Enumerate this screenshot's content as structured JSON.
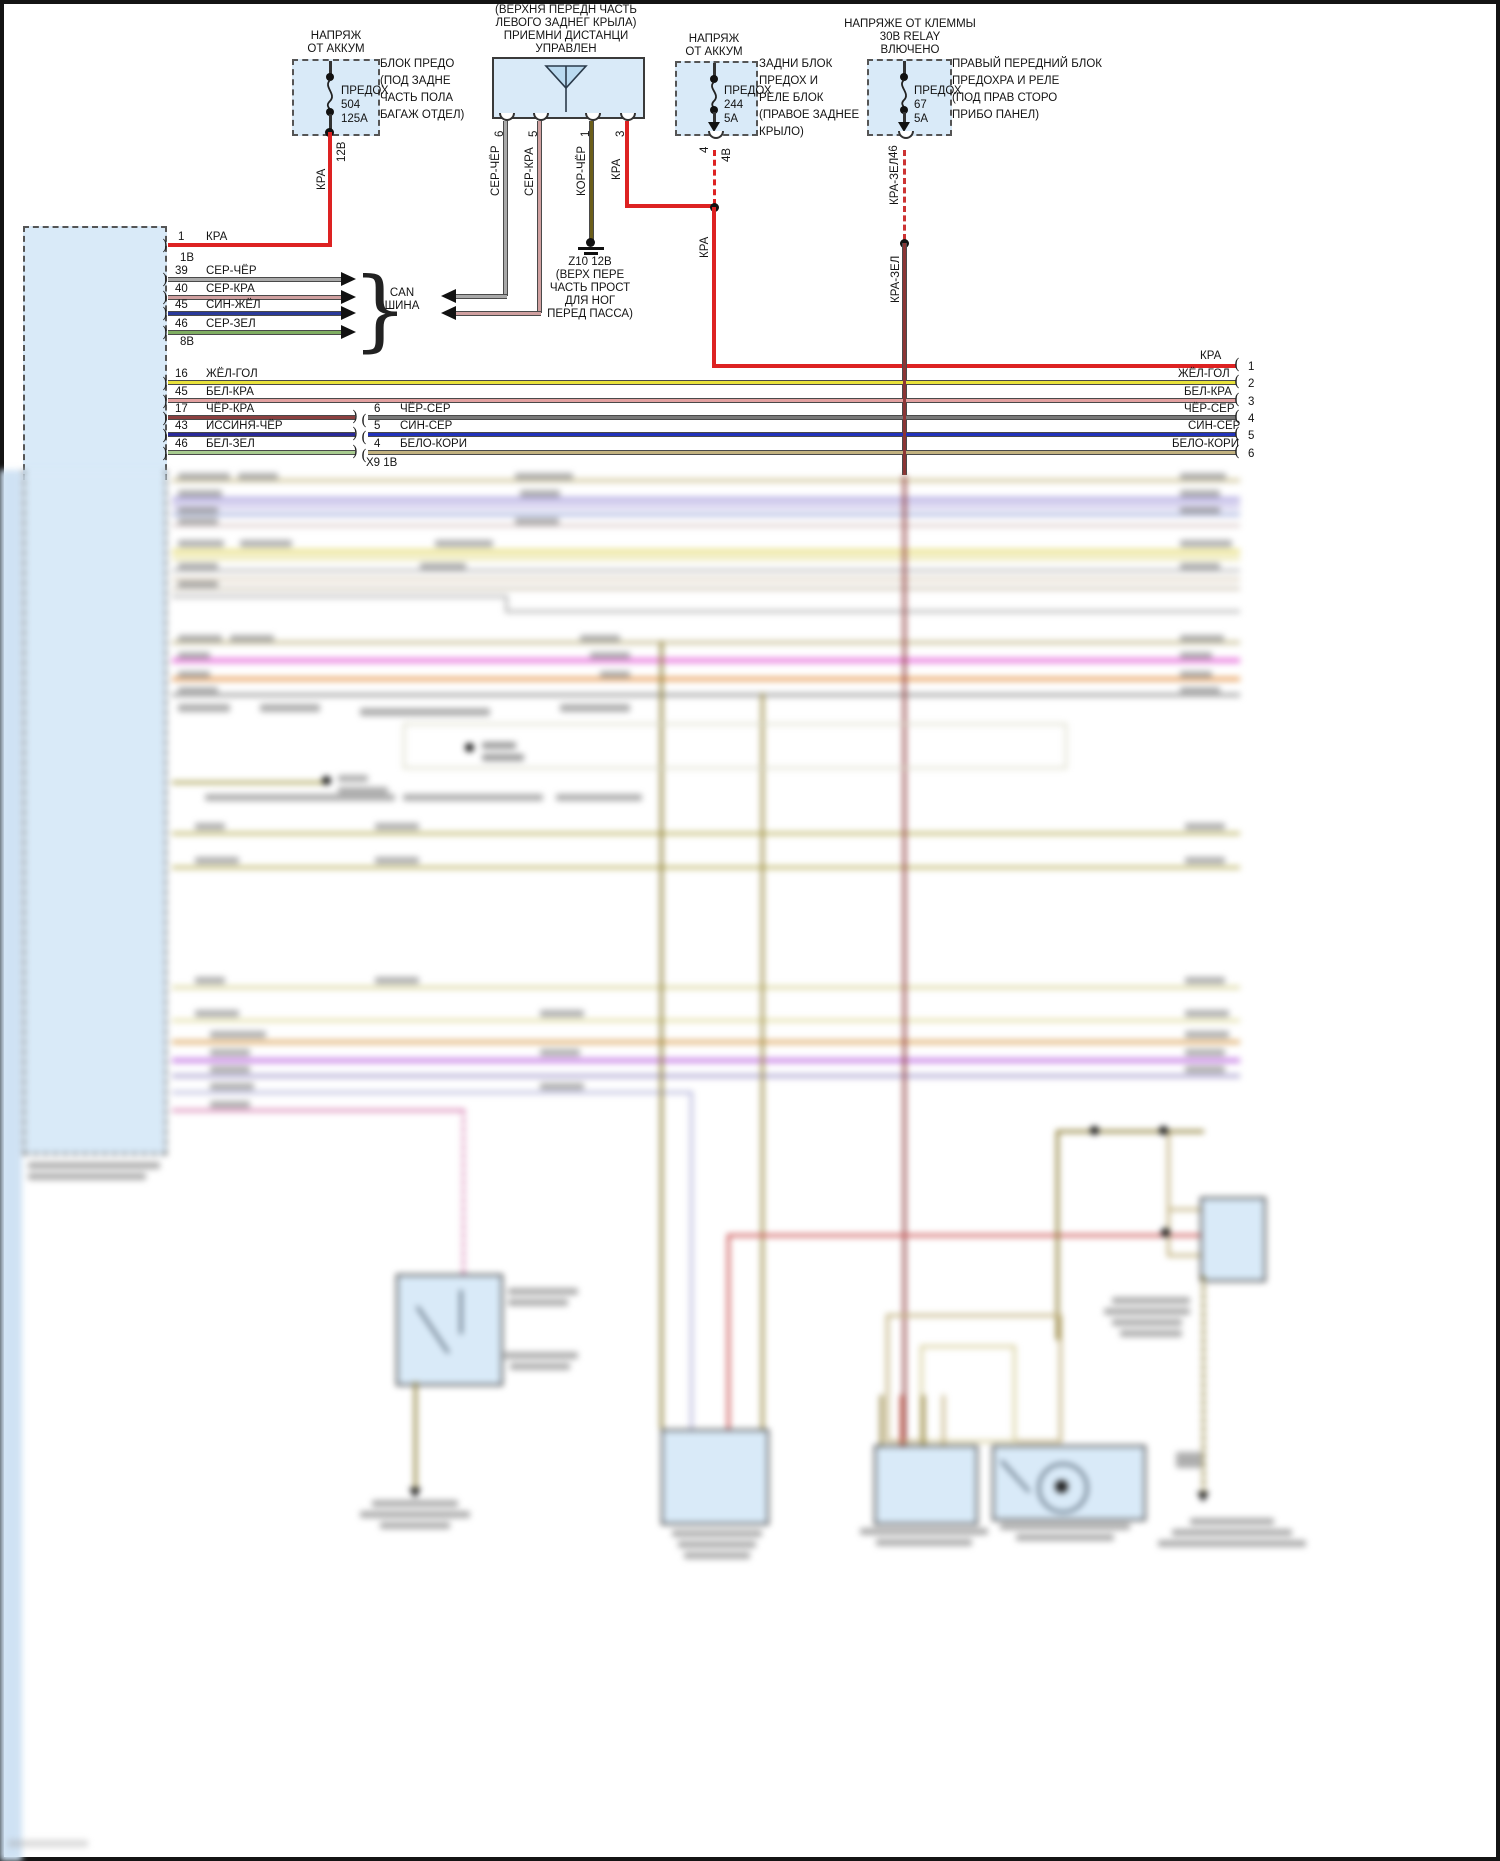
{
  "palette": {
    "power_red": "#dd2222",
    "dark_red_green": "#8b3535",
    "gray_black": "#a9a9a9",
    "gray_red": "#d0a0a0",
    "brown_black": "#6b5e1a",
    "yellow_blue": "#e8e23c",
    "white_red": "#e2a0a0",
    "black_gray": "#787878",
    "blue_gray": "#2233bb",
    "white_brown": "#c2b280",
    "blue_yellow": "#2a3a9a",
    "gray_green": "#7fae62",
    "black_red": "#8b4040",
    "blue_black": "#2a2a99",
    "white_green": "#a8cc90",
    "box_fill": "#d9eaf8"
  },
  "sources": {
    "battery_trunk": {
      "title1": "НАПРЯЖ",
      "title2": "ОТ АККУМ",
      "fuse_name": "ПРЕДОХ",
      "fuse_no": "504",
      "fuse_rating": "125А",
      "loc1": "БЛОК ПРЕДО",
      "loc2": "(ПОД ЗАДНЕ",
      "loc3": "ЧАСТЬ ПОЛА",
      "loc4": "БАГАЖ ОТДЕЛ)",
      "voltage": "12В",
      "wire": "КРА"
    },
    "battery_rear": {
      "title1": "НАПРЯЖ",
      "title2": "ОТ АККУМ",
      "fuse_name": "ПРЕДОХ",
      "fuse_no": "244",
      "fuse_rating": "5А",
      "loc1": "ЗАДНИ БЛОК",
      "loc2": "ПРЕДОХ И",
      "loc3": "РЕЛЕ БЛОК",
      "loc4": "(ПРАВОЕ ЗАДНЕЕ",
      "loc5": "КРЫЛО)",
      "pin": "4",
      "voltage": "4В",
      "wire": "КРА"
    },
    "relay_30": {
      "title1": "НАПРЯЖЕ ОТ КЛЕММЫ",
      "title2": "30В RELAY",
      "title3": "ВЛЮЧЕНО",
      "fuse_name": "ПРЕДОХ",
      "fuse_no": "67",
      "fuse_rating": "5А",
      "loc1": "ПРАВЫЙ ПЕРЕДНИЙ БЛОК",
      "loc2": "ПРЕДОХРА И РЕЛЕ",
      "loc3": "(ПОД ПРАВ СТОРО",
      "loc4": "ПРИБО ПАНЕЛ)",
      "pin": "46",
      "wire": "КРА-ЗЕЛ",
      "wire2": "КРА-ЗЕЛ"
    }
  },
  "antenna": {
    "title1": "(ВЕРХНЯ ПЕРЕДН ЧАСТЬ",
    "title2": "ЛЕВОГО ЗАДНЕГ КРЫЛА)",
    "title3": "ПРИЕМНИ ДИСТАНЦИ",
    "title4": "УПРАВЛЕН",
    "pin6": "6",
    "pin5": "5",
    "pin1": "1",
    "pin3": "3",
    "wire6": "СЕР-ЧЁР",
    "wire5": "СЕР-КРА",
    "wire1": "КОР-ЧЁР",
    "wire3": "КРА"
  },
  "ground": {
    "l1": "Z10 12В",
    "l2": "(ВЕРХ ПЕРЕ",
    "l3": "ЧАСТЬ ПРОСТ",
    "l4": "ДЛЯ НОГ",
    "l5": "ПЕРЕД ПАССА)"
  },
  "can": {
    "l1": "CAN",
    "l2": "ШИНА"
  },
  "module": {
    "power_row": {
      "pin": "1",
      "wire": "КРА",
      "connector": "1В"
    },
    "can_rows": [
      {
        "pin": "39",
        "wire": "СЕР-ЧЁР"
      },
      {
        "pin": "40",
        "wire": "СЕР-КРА"
      },
      {
        "pin": "45",
        "wire": "СИН-ЖЁЛ"
      },
      {
        "pin": "46",
        "wire": "СЕР-ЗЕЛ"
      }
    ],
    "can_connector": "8В",
    "rows": [
      {
        "pin": "16",
        "wire": "ЖЁЛ-ГОЛ",
        "right_wire": "ЖЁЛ-ГОЛ",
        "right_pin": "2"
      },
      {
        "pin": "45",
        "wire": "БЕЛ-КРА",
        "right_wire": "БЕЛ-КРА",
        "right_pin": "3"
      },
      {
        "pin": "17",
        "wire": "ЧЁР-КРА",
        "mid_pin": "6",
        "mid_wire": "ЧЁР-СЕР",
        "right_wire": "ЧЁР-СЕР",
        "right_pin": "4"
      },
      {
        "pin": "43",
        "wire": "ИССИНЯ-ЧЁР",
        "mid_pin": "5",
        "mid_wire": "СИН-СЕР",
        "right_wire": "СИН-СЕР",
        "right_pin": "5"
      },
      {
        "pin": "46",
        "wire": "БЕЛ-ЗЕЛ",
        "mid_pin": "4",
        "mid_wire": "БЕЛО-КОРИ",
        "right_wire": "БЕЛО-КОРИ",
        "right_pin": "6"
      }
    ],
    "x9": "Х9 1В"
  },
  "feed_row": {
    "wire": "КРА",
    "pin": "1"
  }
}
